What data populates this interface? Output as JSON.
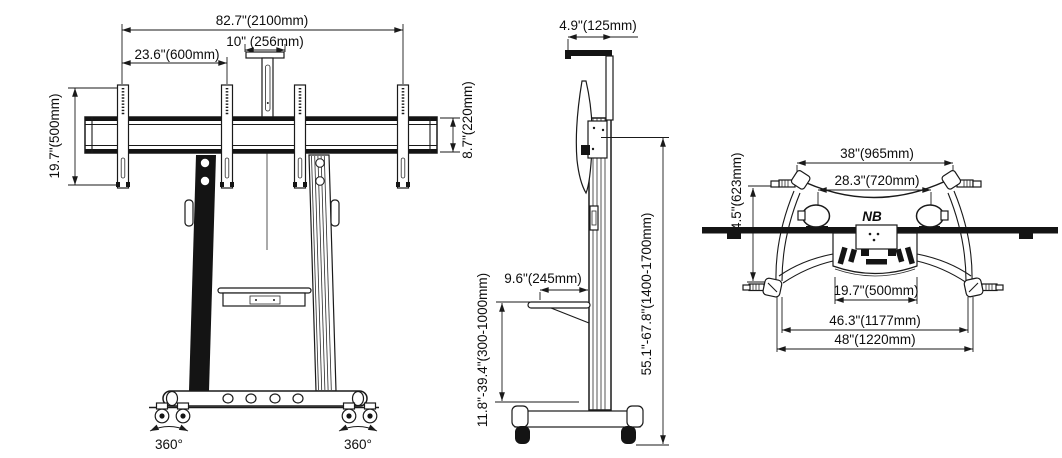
{
  "diagram": {
    "kind": "technical-dimensional-drawing",
    "units": "inches (millimeters)"
  },
  "views": {
    "front": {
      "dim_overall_width": "82.7\"(2100mm)",
      "dim_center_mount_width": "10\" (256mm)",
      "dim_bracket_offset": "23.6\"(600mm)",
      "dim_bracket_height": "19.7\"(500mm)",
      "dim_beam_depth": "8.7\"(220mm)",
      "caster_rotation_left": "360°",
      "caster_rotation_right": "360°"
    },
    "side": {
      "dim_top_mount_depth": "4.9\"(125mm)",
      "dim_shelf_depth": "9.6\"(245mm)",
      "dim_shelf_height_range": "11.8\"-39.4\"(300-1000mm)",
      "dim_overall_height_range": "55.1\"-67.8\"(1400-1700mm)"
    },
    "top": {
      "dim_handle_span": "38\"(965mm)",
      "dim_inner_span": "28.3\"(720mm)",
      "dim_depth": "24.5\"(623mm)",
      "dim_shelf_width": "19.7\"(500mm)",
      "dim_caster_span": "46.3\"(1177mm)",
      "dim_overall_width": "48\"(1220mm)",
      "logo": "NB"
    }
  }
}
